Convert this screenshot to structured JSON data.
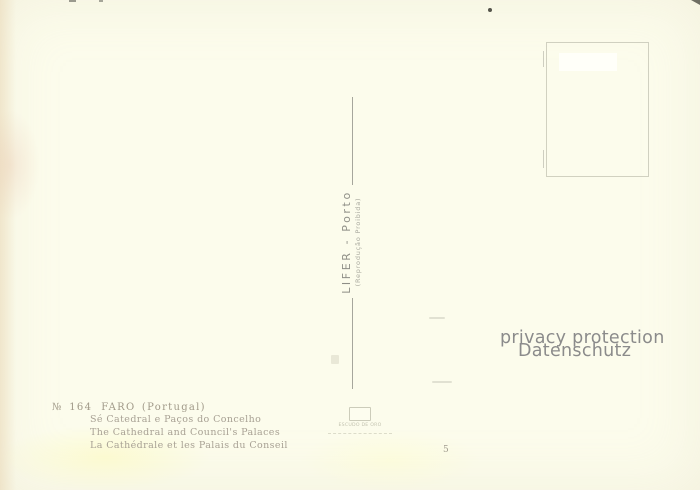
{
  "postcard": {
    "publisher_imprint": {
      "name": "LIFER - Porto",
      "note": "(Reprodução Proibida)"
    },
    "caption": {
      "catalog_no": "№ 164",
      "title": "FARO (Portugal)",
      "lines": [
        "Sé Catedral e Paços do Concelho",
        "The Cathedral and Council's Palaces",
        "La Cathédrale et les Palais du Conseil"
      ]
    },
    "emblem_text": "ESCUDO DE ORO",
    "plate_number": "5",
    "colors": {
      "paper": "#fcfcec",
      "caption_ink": "#a59e8f",
      "imprint_ink": "#8e8e86",
      "divider": "#96968e"
    }
  },
  "watermark": {
    "line1": "privacy protection",
    "line2": "Datenschutz",
    "color": "#8b8b8b"
  }
}
